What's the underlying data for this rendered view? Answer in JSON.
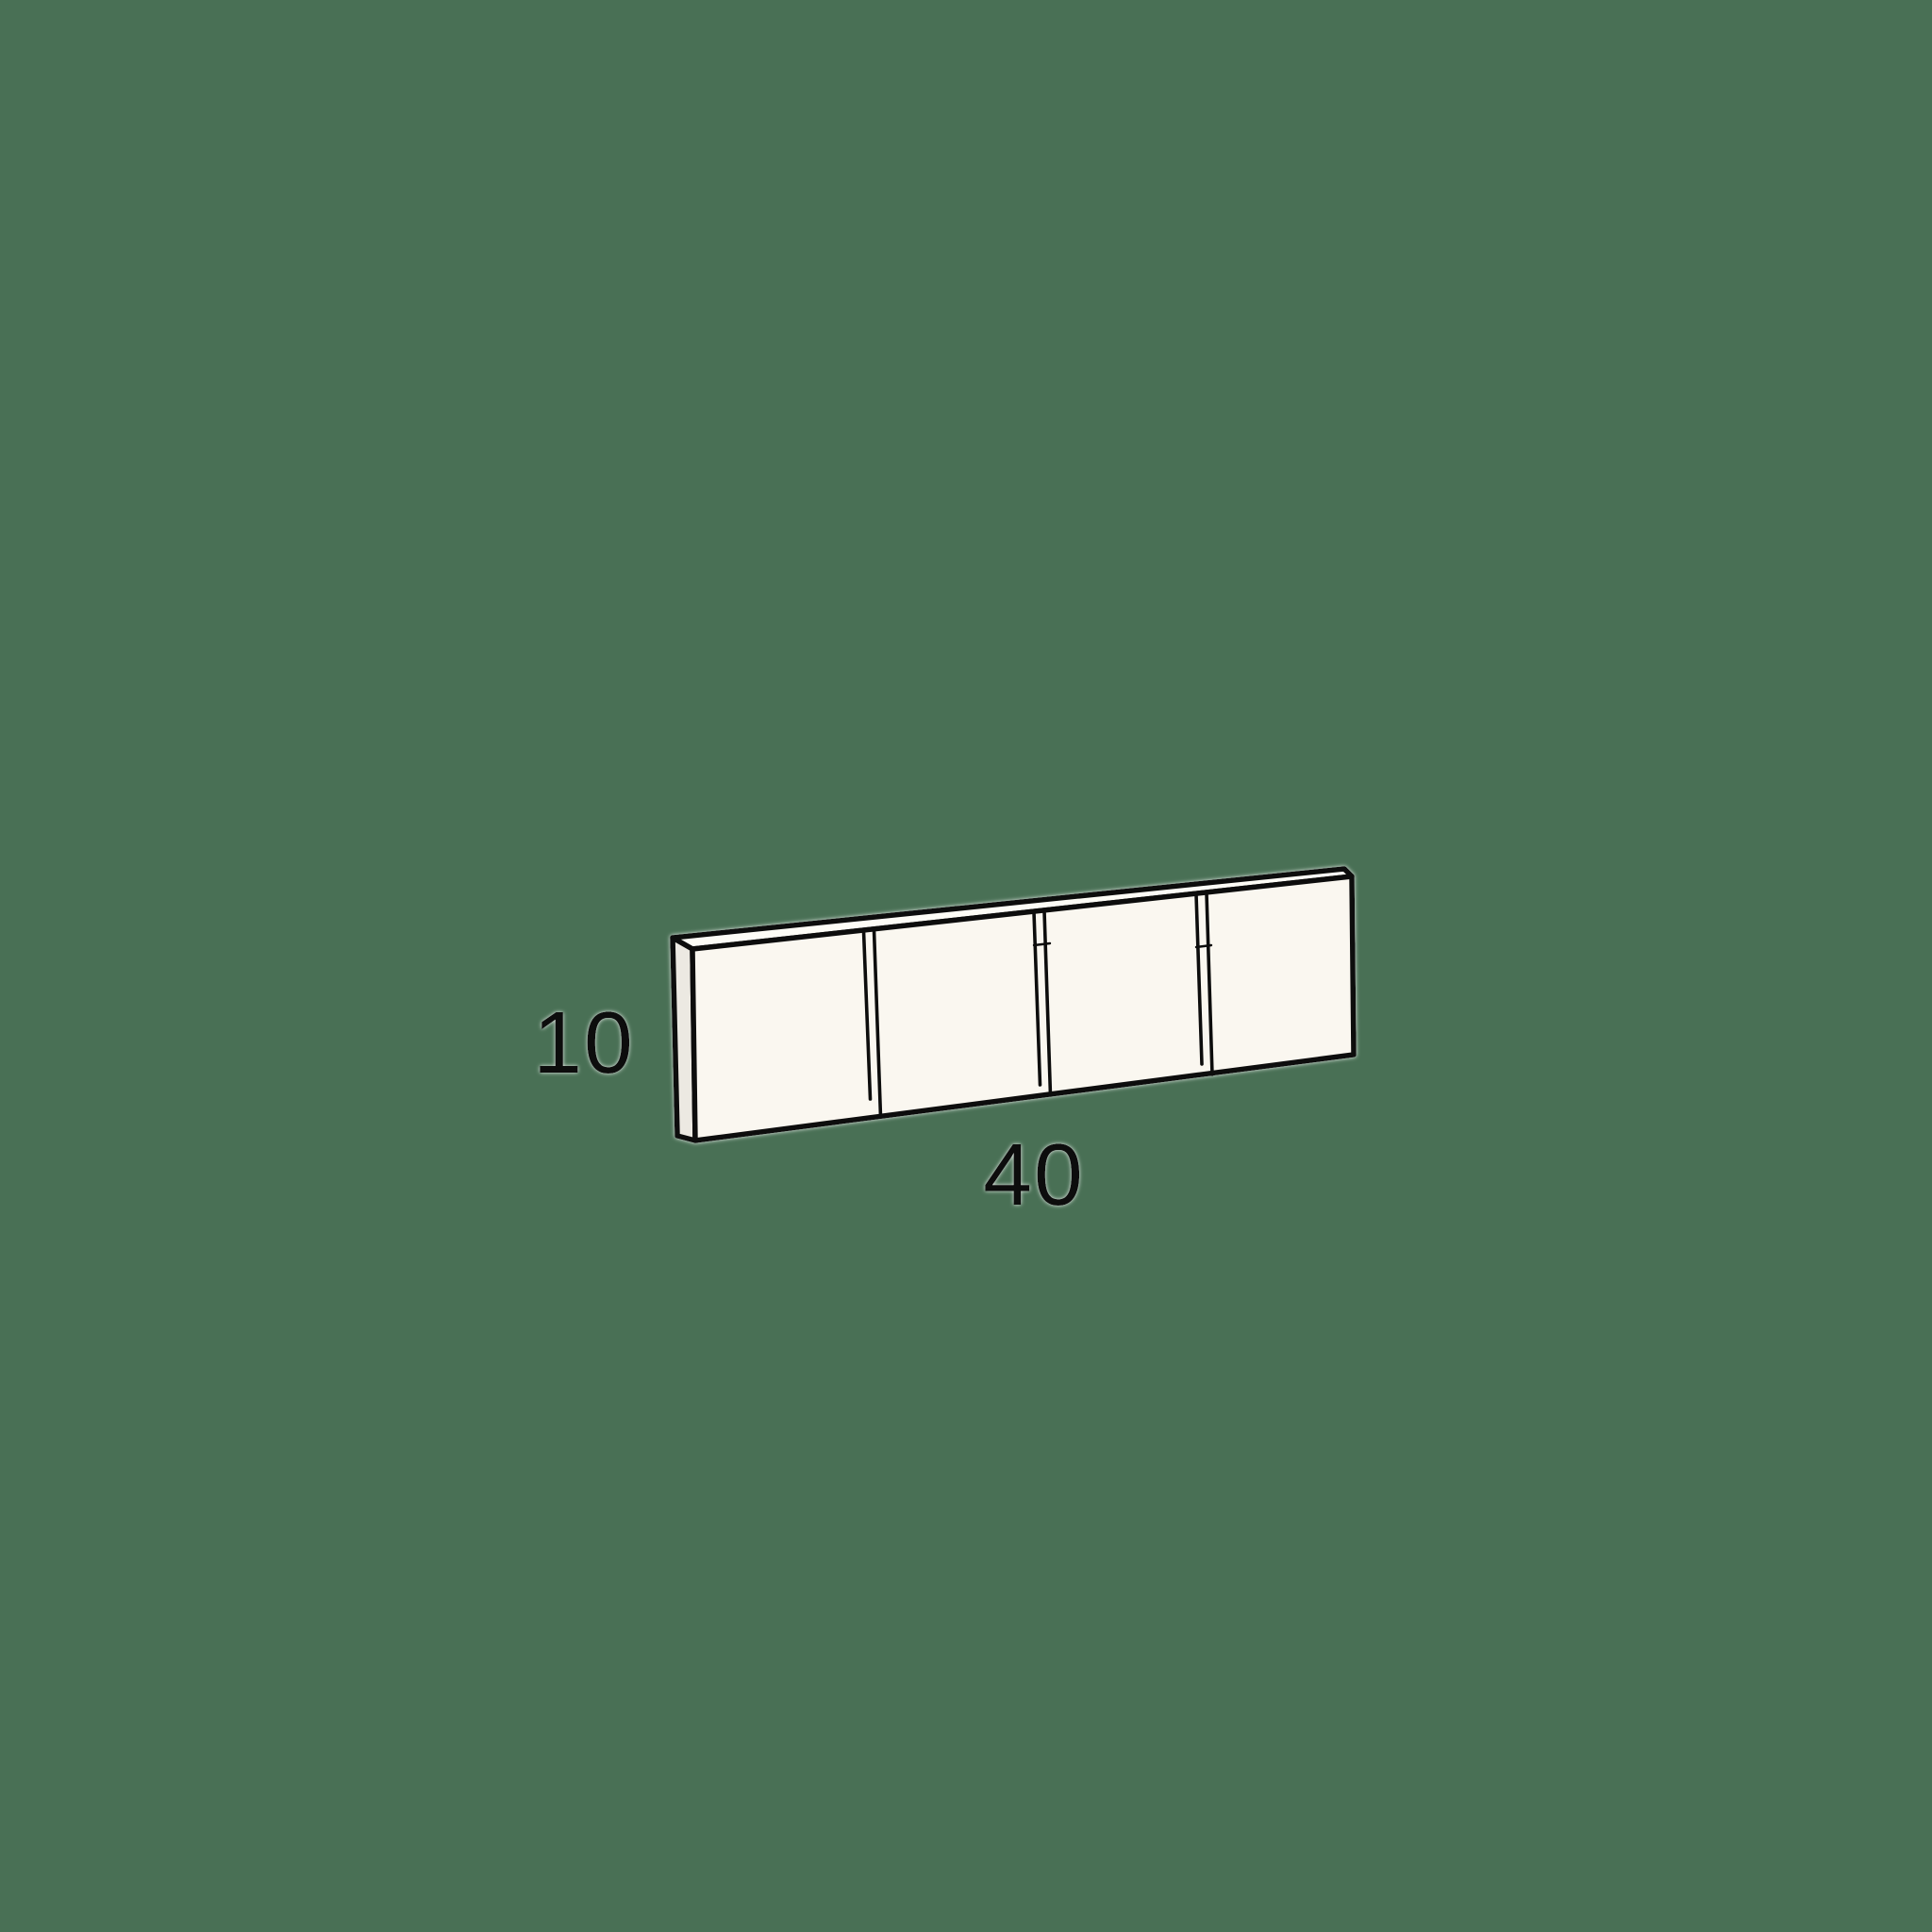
{
  "diagram": {
    "panel_count": 4,
    "dimension_labels": {
      "height": "10",
      "width": "40"
    },
    "colors": {
      "background": "#497055",
      "panel_front": "#FAF7F0",
      "panel_side": "#ECE9E2",
      "panel_top": "#FDFCF6",
      "outline": "#0E0E0E",
      "label_text": "#111111"
    }
  }
}
